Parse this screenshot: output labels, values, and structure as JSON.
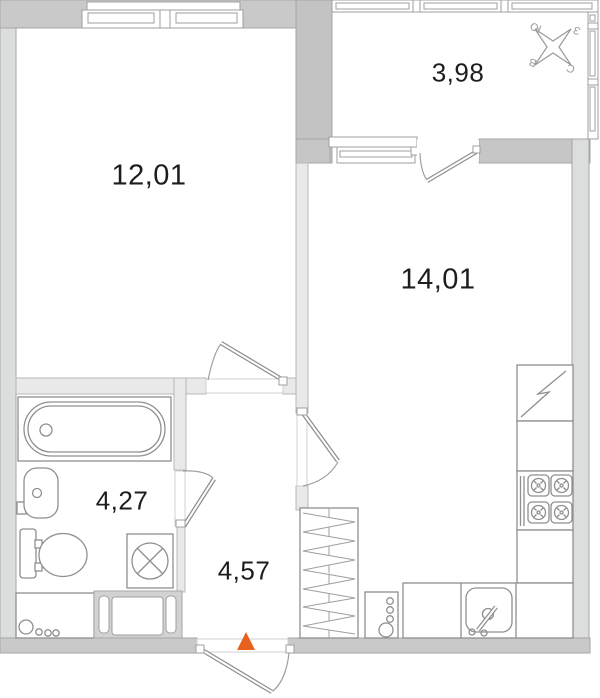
{
  "rooms": {
    "living": {
      "area": "12,01"
    },
    "balcony": {
      "area": "3,98"
    },
    "kitchen": {
      "area": "14,01"
    },
    "bathroom": {
      "area": "4,27"
    },
    "hallway": {
      "area": "4,57"
    }
  },
  "compass": {
    "north": "С",
    "south": "Ю",
    "east": "В",
    "west": "З"
  },
  "colors": {
    "exterior_wall": "#c9c9c9",
    "side_wall": "#dcdddd",
    "partition_wall": "#e9e9e9",
    "fixture_line": "#8f8f8f",
    "entrance_marker": "#e8611d",
    "label_text": "#1d1d1b"
  },
  "icons": [
    "window-icon",
    "balcony-glazing-icon",
    "compass-rose-icon",
    "door-swing-icon",
    "bathtub-icon",
    "washbasin-icon",
    "toilet-icon",
    "washing-machine-icon",
    "vent-shaft-icon",
    "fridge-icon",
    "stove-icon",
    "kitchen-sink-icon",
    "riser-pipes-icon",
    "entrance-arrow-icon"
  ]
}
